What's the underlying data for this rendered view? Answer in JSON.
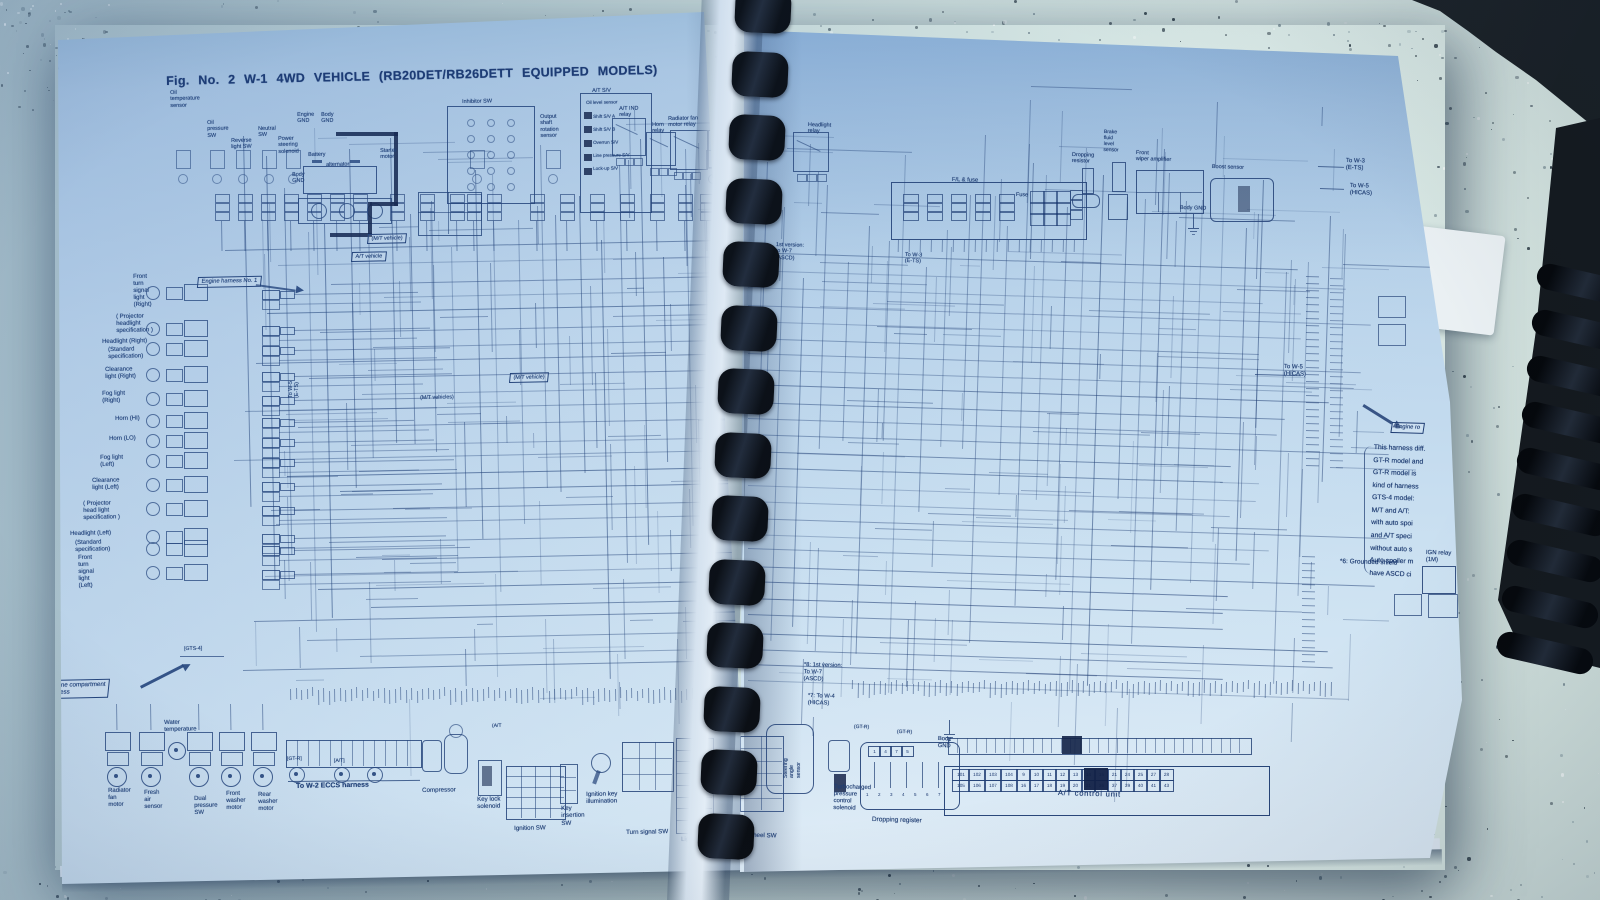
{
  "title": "Fig. No. 2 W-1 4WD VEHICLE (RB20DET/RB26DETT EQUIPPED MODELS)",
  "colors": {
    "ink": "#1e3c72",
    "ink_strong": "#101f44",
    "page": "#c6dcef",
    "counter": "#ccdcd8",
    "binding": "#0a0d12"
  },
  "labels": {
    "left": [
      {
        "t": "Oil\ntemperature\nsensor",
        "x": 170,
        "y": 90,
        "fs": 5.5
      },
      {
        "t": "Oil\npressure\nSW",
        "x": 207,
        "y": 120,
        "fs": 5.5
      },
      {
        "t": "Reverse\nlight SW",
        "x": 231,
        "y": 138,
        "fs": 5.5
      },
      {
        "t": "Neutral\nSW",
        "x": 258,
        "y": 126,
        "fs": 5.5
      },
      {
        "t": "Power\nsteering\nsolenoid",
        "x": 278,
        "y": 136,
        "fs": 5.5
      },
      {
        "t": "Engine\nGND",
        "x": 297,
        "y": 112,
        "fs": 5.5
      },
      {
        "t": "Body\nGND",
        "x": 321,
        "y": 112,
        "fs": 5.5
      },
      {
        "t": "Battery",
        "x": 308,
        "y": 152,
        "fs": 5.5
      },
      {
        "t": "alternator",
        "x": 326,
        "y": 162,
        "fs": 5.5
      },
      {
        "t": "Starter\nmotor",
        "x": 380,
        "y": 148,
        "fs": 5.5
      },
      {
        "t": "Body\nGND",
        "x": 292,
        "y": 172,
        "fs": 5.5
      },
      {
        "t": "(M/T vehicle)",
        "x": 368,
        "y": 234,
        "fs": 5.4,
        "box": 1
      },
      {
        "t": "A/T vehicle",
        "x": 352,
        "y": 252,
        "fs": 5.4,
        "box": 1
      },
      {
        "t": "Inhibitor SW",
        "x": 462,
        "y": 99,
        "fs": 5.5
      },
      {
        "t": "Output\nshaft\nrotation\nsensor",
        "x": 540,
        "y": 114,
        "fs": 5.5
      },
      {
        "t": "A/T S/V",
        "x": 592,
        "y": 88,
        "fs": 5.5
      },
      {
        "t": "Oil level sensor",
        "x": 586,
        "y": 100,
        "fs": 4.6
      },
      {
        "t": "Shift S/V A",
        "x": 593,
        "y": 114,
        "fs": 4.6
      },
      {
        "t": "Shift S/V B",
        "x": 593,
        "y": 127,
        "fs": 4.6
      },
      {
        "t": "Overrun S/V",
        "x": 593,
        "y": 140,
        "fs": 4.6
      },
      {
        "t": "Line pressure S/V",
        "x": 593,
        "y": 153,
        "fs": 4.6
      },
      {
        "t": "Lock-up S/V",
        "x": 593,
        "y": 166,
        "fs": 4.6
      },
      {
        "t": "A/T IND\nrelay",
        "x": 619,
        "y": 106,
        "fs": 5.5
      },
      {
        "t": "Horn\nrelay",
        "x": 652,
        "y": 122,
        "fs": 5.5
      },
      {
        "t": "Radiator fan\nmotor relay",
        "x": 668,
        "y": 116,
        "fs": 5.5
      },
      {
        "t": "A/C\nrelay",
        "x": 714,
        "y": 118,
        "fs": 5.5
      },
      {
        "t": "Engine harness No. 1",
        "x": 198,
        "y": 277,
        "fs": 5.8,
        "box": 1
      },
      {
        "t": "To W-5\n(E-TS)",
        "x": 288,
        "y": 398,
        "fs": 5.4,
        "r": -90
      },
      {
        "t": "(M/T vehicle)",
        "x": 510,
        "y": 373,
        "fs": 5.4,
        "box": 1
      },
      {
        "t": "(M/T vehicles)",
        "x": 420,
        "y": 395,
        "fs": 5.4
      },
      {
        "t": "[GTS-4]",
        "x": 184,
        "y": 646,
        "fs": 5.2
      },
      {
        "t": "Front\nturn\nsignal\nlight\n(Right)",
        "x": 133,
        "y": 274,
        "fs": 6
      },
      {
        "t": "( Projector\nheadlight\nspecification )",
        "x": 116,
        "y": 314,
        "fs": 6
      },
      {
        "t": "Headlight (Right)",
        "x": 102,
        "y": 339,
        "fs": 6
      },
      {
        "t": "(Standard\nspecification)",
        "x": 108,
        "y": 347,
        "fs": 6
      },
      {
        "t": "Clearance\nlight (Right)",
        "x": 105,
        "y": 367,
        "fs": 6
      },
      {
        "t": "Fog light\n(Right)",
        "x": 102,
        "y": 391,
        "fs": 6
      },
      {
        "t": "Horn (HI)",
        "x": 115,
        "y": 416,
        "fs": 6
      },
      {
        "t": "Horn (LO)",
        "x": 109,
        "y": 436,
        "fs": 6
      },
      {
        "t": "Fog light\n(Left)",
        "x": 100,
        "y": 455,
        "fs": 6
      },
      {
        "t": "Clearance\nlight (Left)",
        "x": 92,
        "y": 478,
        "fs": 6
      },
      {
        "t": "( Projector\nhead light\nspecification )",
        "x": 83,
        "y": 501,
        "fs": 6
      },
      {
        "t": "Headlight (Left)",
        "x": 70,
        "y": 531,
        "fs": 6
      },
      {
        "t": "(Standard\nspecification)",
        "x": 75,
        "y": 540,
        "fs": 6
      },
      {
        "t": "Front\nturn\nsignal\nlight\n(Left)",
        "x": 78,
        "y": 555,
        "fs": 6
      },
      {
        "t": "Engine compartment\nharness",
        "x": 45,
        "y": 680,
        "fs": 6.2,
        "box": 1
      },
      {
        "t": "Water\ntemperature",
        "x": 164,
        "y": 720,
        "fs": 6
      },
      {
        "t": "Radiator\nfan\nmotor",
        "x": 108,
        "y": 788,
        "fs": 6
      },
      {
        "t": "Fresh\nair\nsensor",
        "x": 144,
        "y": 790,
        "fs": 6
      },
      {
        "t": "Dual\npressure\nSW",
        "x": 194,
        "y": 796,
        "fs": 6
      },
      {
        "t": "Front\nwasher\nmotor",
        "x": 226,
        "y": 791,
        "fs": 6
      },
      {
        "t": "Rear\nwasher\nmotor",
        "x": 258,
        "y": 792,
        "fs": 6
      },
      {
        "t": "[GT-R]",
        "x": 287,
        "y": 757,
        "fs": 5
      },
      {
        "t": "[A/T]",
        "x": 334,
        "y": 759,
        "fs": 5
      },
      {
        "t": "To W-2 ECCS harness",
        "x": 296,
        "y": 783,
        "fs": 7,
        "b": 1
      },
      {
        "t": "Compressor",
        "x": 422,
        "y": 787,
        "fs": 6.2
      },
      {
        "t": "(A/T",
        "x": 492,
        "y": 724,
        "fs": 5
      },
      {
        "t": "Key lock\nsolenoid",
        "x": 477,
        "y": 796,
        "fs": 6.2
      },
      {
        "t": "Ignition SW",
        "x": 514,
        "y": 825,
        "fs": 6.2
      },
      {
        "t": "Key\ninsertion\nSW",
        "x": 561,
        "y": 805,
        "fs": 6.2
      },
      {
        "t": "Ignition key\nillumination",
        "x": 586,
        "y": 791,
        "fs": 6.2
      },
      {
        "t": "Turn signal SW",
        "x": 626,
        "y": 829,
        "fs": 6.2
      },
      {
        "t": "Light SW",
        "x": 681,
        "y": 836,
        "fs": 6.2
      }
    ],
    "right": [
      {
        "t": "Headlight\nrelay",
        "x": 808,
        "y": 122,
        "fs": 5.5
      },
      {
        "t": "F/L & fuse",
        "x": 952,
        "y": 177,
        "fs": 5.8
      },
      {
        "t": "Fuse",
        "x": 1016,
        "y": 192,
        "fs": 5.5
      },
      {
        "t": "Dropping\nresistor",
        "x": 1072,
        "y": 152,
        "fs": 5.5
      },
      {
        "t": "Brake\nfluid\nlevel\nsensor",
        "x": 1104,
        "y": 130,
        "fs": 5
      },
      {
        "t": "Front\nwiper amplifier",
        "x": 1136,
        "y": 150,
        "fs": 5.5
      },
      {
        "t": "Boost sensor",
        "x": 1212,
        "y": 164,
        "fs": 5.5
      },
      {
        "t": "Body GND",
        "x": 1180,
        "y": 205,
        "fs": 5.5
      },
      {
        "t": "To W-3\n(E-TS)",
        "x": 1346,
        "y": 158,
        "fs": 6
      },
      {
        "t": "To W-5\n(HICAS)",
        "x": 1350,
        "y": 183,
        "fs": 6
      },
      {
        "t": "1st version:\nto W-7\n(ASCD)",
        "x": 776,
        "y": 242,
        "fs": 5.5
      },
      {
        "t": "To W-3\n(E-TS)",
        "x": 905,
        "y": 252,
        "fs": 5.5
      },
      {
        "t": "To W-5\n(HICAS)",
        "x": 1284,
        "y": 364,
        "fs": 6
      },
      {
        "t": "Engine ro",
        "x": 1392,
        "y": 422,
        "fs": 5.8,
        "box": 1
      },
      {
        "t": "This harness diff.\nGT-R model and\nGT-R model is\nkind of harness\nGTS-4 model:\nM/T and A/T:\nwith auto spoi\nand A/T speci\nwithout auto s\nAuto spoiler m\nhave ASCD ci",
        "x": 1374,
        "y": 442,
        "fs": 6.8,
        "lh": 1.85,
        "r": 2
      },
      {
        "t": "*6: Grounded shield",
        "x": 1340,
        "y": 558,
        "fs": 6.5
      },
      {
        "t": "IGN relay\n(1M)",
        "x": 1426,
        "y": 550,
        "fs": 6
      },
      {
        "t": "*8: 1st version:\nTo W-7\n(ASCD)",
        "x": 804,
        "y": 662,
        "fs": 5.8
      },
      {
        "t": "*7: To W-4\n(HICAS)",
        "x": 808,
        "y": 693,
        "fs": 5.8
      },
      {
        "t": "(GT-R)",
        "x": 854,
        "y": 725,
        "fs": 5
      },
      {
        "t": "(GT-R)",
        "x": 897,
        "y": 730,
        "fs": 5
      },
      {
        "t": "Steering wheel SW",
        "x": 724,
        "y": 831,
        "fs": 6.2
      },
      {
        "t": "Steering\nangle\nsensor",
        "x": 783,
        "y": 778,
        "fs": 5.3,
        "r": -90
      },
      {
        "t": "Turbocharged\npressure\ncontrol\nsolenoid",
        "x": 834,
        "y": 784,
        "fs": 6
      },
      {
        "t": "Dropping register",
        "x": 872,
        "y": 816,
        "fs": 6.5
      },
      {
        "t": "Body\nGND",
        "x": 938,
        "y": 736,
        "fs": 5.8
      },
      {
        "t": "A/T control unit",
        "x": 1058,
        "y": 789,
        "fs": 7.5,
        "ls": 0.8
      }
    ]
  },
  "at_control_unit": {
    "pins_row1": [
      "101",
      "102",
      "103",
      "104",
      "9",
      "10",
      "11",
      "12",
      "13",
      "14",
      "15",
      "21",
      "24",
      "25",
      "27",
      "28"
    ],
    "pins_row2": [
      "105",
      "106",
      "107",
      "108",
      "16",
      "17",
      "18",
      "19",
      "20",
      "21",
      "36",
      "37",
      "39",
      "40",
      "41",
      "43"
    ]
  },
  "dropping_register": {
    "pins_top": [
      "1",
      "4",
      "7",
      "5"
    ],
    "pins_bottom": [
      "1",
      "2",
      "3",
      "4",
      "5",
      "6",
      "7"
    ]
  }
}
